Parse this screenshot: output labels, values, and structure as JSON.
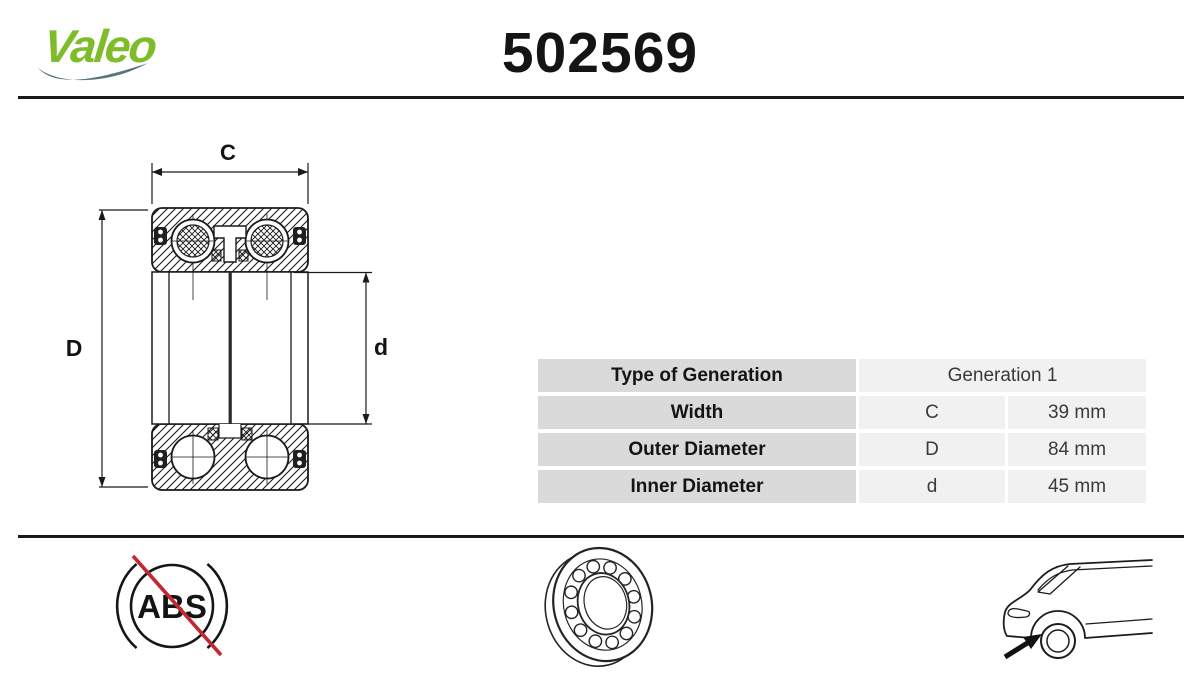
{
  "header": {
    "logo_text": "Valeo",
    "part_number": "502569"
  },
  "diagram": {
    "dim_width": "C",
    "dim_outer": "D",
    "dim_inner": "d"
  },
  "table": {
    "rows": [
      {
        "label": "Type of Generation",
        "symbol": "",
        "value": "Generation 1"
      },
      {
        "label": "Width",
        "symbol": "C",
        "value": "39 mm"
      },
      {
        "label": "Outer Diameter",
        "symbol": "D",
        "value": "84 mm"
      },
      {
        "label": "Inner Diameter",
        "symbol": "d",
        "value": "45 mm"
      }
    ]
  },
  "footer": {
    "abs_label": "ABS",
    "icons": {
      "left": "no-abs-icon",
      "center": "bearing-icon",
      "right": "car-rear-wheel-icon"
    }
  },
  "colors": {
    "logo_green": "#7fbc2a",
    "logo_swoosh": "#57757d",
    "table_label_bg": "#dadada",
    "table_value_bg": "#f1f1f1",
    "abs_red": "#c32733",
    "ink": "#1a1a1a"
  }
}
